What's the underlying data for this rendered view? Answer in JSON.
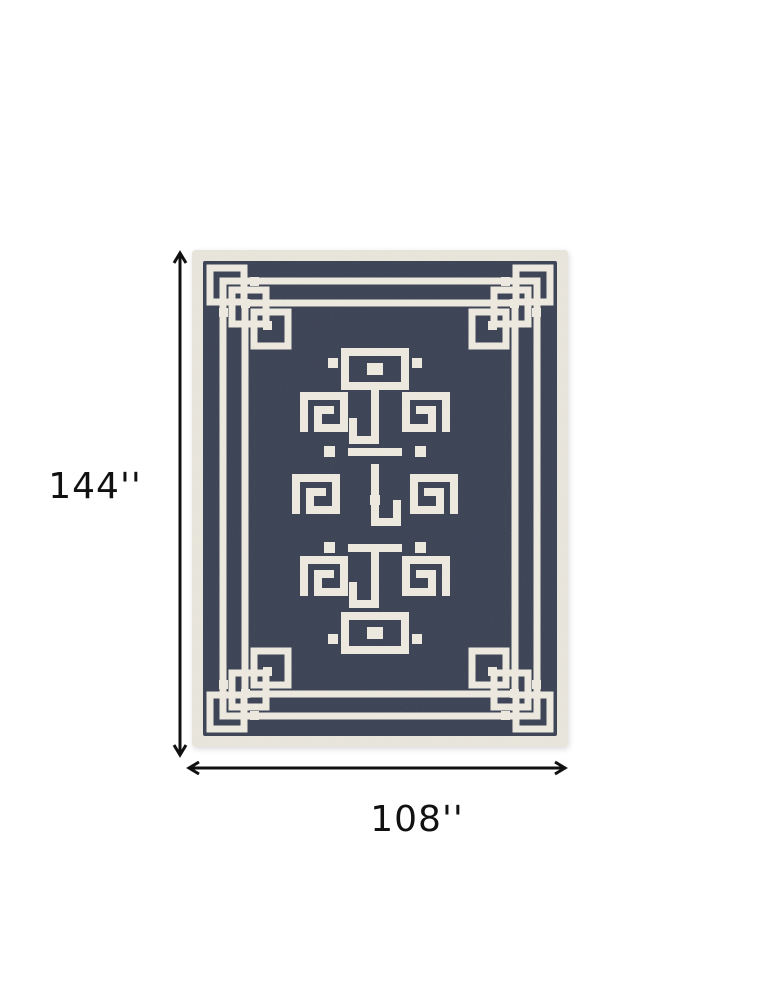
{
  "diagram": {
    "kind": "rug-dimension-diagram",
    "dimensions": {
      "height_label": "144''",
      "width_label": "108''"
    }
  },
  "rug": {
    "pattern": "greek-key-medallion-with-corner-knots",
    "field_color": "#3a4154",
    "pattern_color": "#eeeae0",
    "binding_color": "#e9e6dc"
  },
  "colors": {
    "background": "#ffffff",
    "rug_navy": "#3a4154",
    "rug_binding": "#e9e6dc",
    "pattern_ivory": "#eeeae0",
    "dimension_line": "#111111",
    "label_text": "#111111"
  }
}
